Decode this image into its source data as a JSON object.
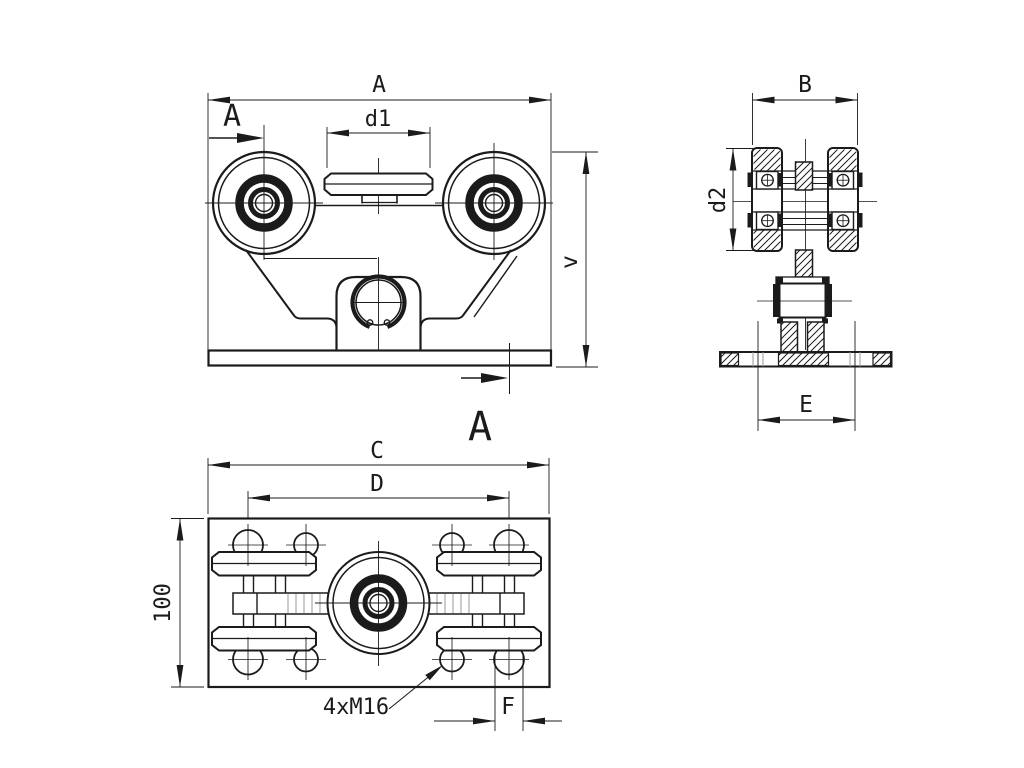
{
  "drawing": {
    "background": "#ffffff",
    "line_color": "#1b1b1b",
    "hidden_line_color": "#9a9a9a",
    "front_view": {
      "dim_overall_width": "A",
      "dim_guide_roller_width": "d1",
      "dim_height": "v",
      "section_label_top": "A",
      "section_label_bottom": "A"
    },
    "side_view": {
      "dim_overall_width": "B",
      "dim_roller_diameter": "d2",
      "dim_stud_spacing": "E"
    },
    "plan_view": {
      "dim_plate_length": "C",
      "dim_axle_spacing": "D",
      "dim_plate_width": "100",
      "dim_stud_diameter": "F",
      "thread_callout": "4xM16"
    }
  }
}
